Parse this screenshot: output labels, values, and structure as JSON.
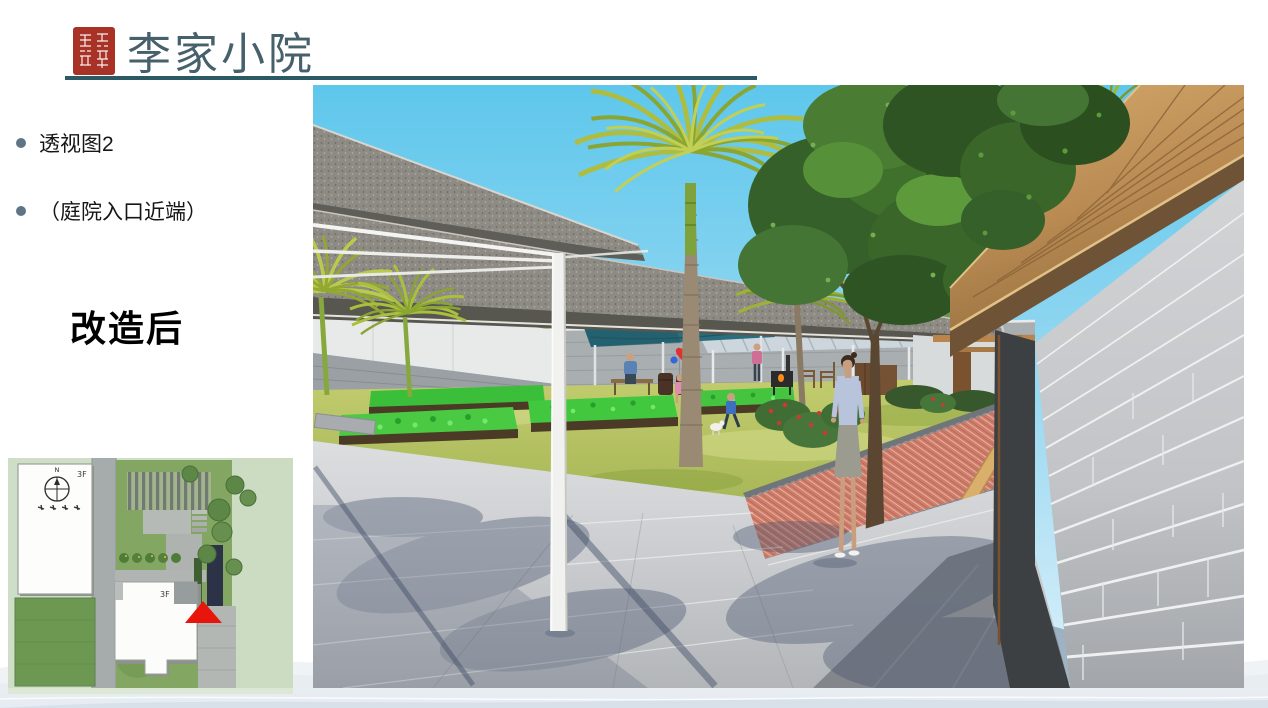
{
  "slide": {
    "title": "李家小院",
    "bullets": [
      {
        "label": "透视图2"
      },
      {
        "label": "（庭院入口近端）"
      }
    ],
    "state_label": "改造后"
  },
  "site_plan": {
    "north_label": "N",
    "floor_labels": [
      "3F",
      "3F"
    ]
  },
  "colors": {
    "accent_teal": "#2c5a64",
    "seal_red": "#a93226",
    "title_text": "#46606c",
    "bullet_dot": "#5f7586",
    "sky_blue": "#5ec7ec",
    "canopy_teal": "#2a6d7e",
    "lawn_green": "#a9b855",
    "path_red": "#cf7d6b",
    "brick_wall_gray": "#c6c8ca",
    "wood_tan": "#c0955c",
    "viewpoint_marker_red": "#e8150d"
  }
}
